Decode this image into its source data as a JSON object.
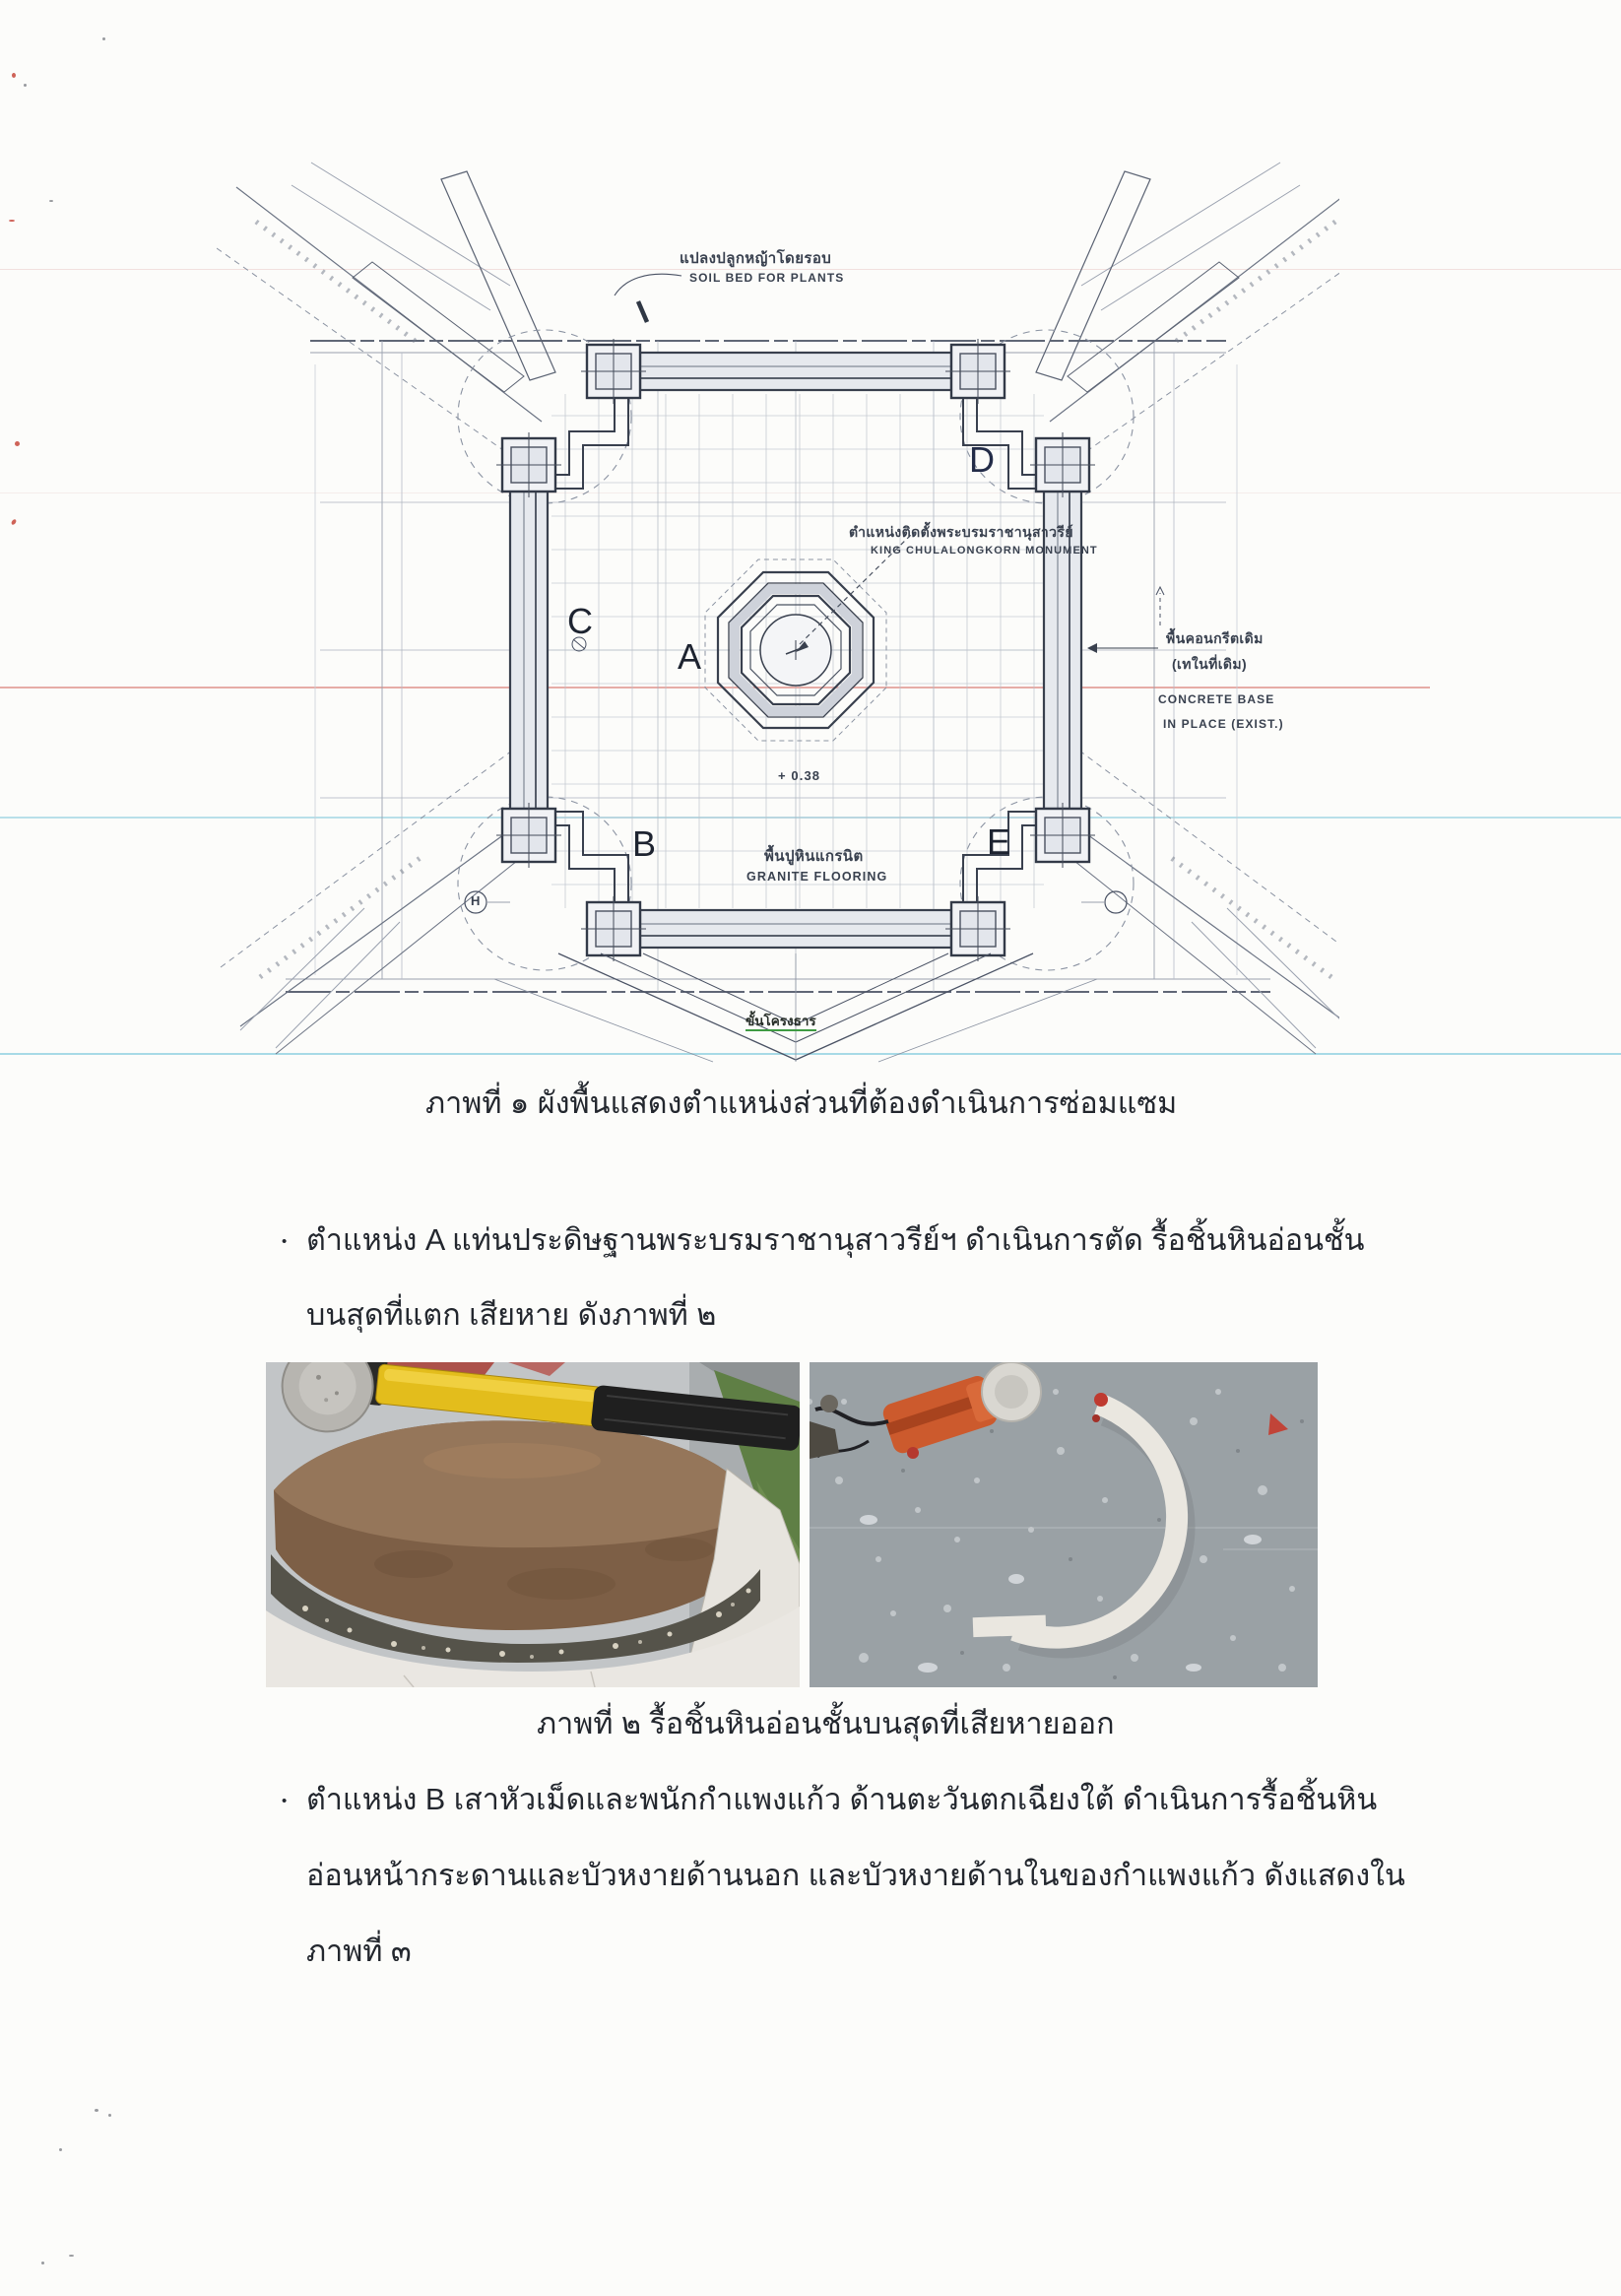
{
  "document": {
    "figure1_caption": "ภาพที่ ๑ ผังพื้นแสดงตำแหน่งส่วนที่ต้องดำเนินการซ่อมแซม",
    "figure2_caption": "ภาพที่ ๒ รื้อชิ้นหินอ่อนชั้นบนสุดที่เสียหายออก",
    "bullets": [
      {
        "marker": "•",
        "lines": [
          "ตำแหน่ง A แท่นประดิษฐานพระบรมราชานุสาวรีย์ฯ ดำเนินการตัด รื้อชิ้นหินอ่อนชั้น",
          "บนสุดที่แตก เสียหาย ดังภาพที่ ๒"
        ]
      },
      {
        "marker": "•",
        "lines": [
          "ตำแหน่ง B เสาหัวเม็ดและพนักกำแพงแก้ว ด้านตะวันตกเฉียงใต้ ดำเนินการรื้อชิ้นหิน",
          "อ่อนหน้ากระดานและบัวหงายด้านนอก และบัวหงายด้านในของกำแพงแก้ว ดังแสดงใน",
          "ภาพที่ ๓"
        ]
      }
    ]
  },
  "plan": {
    "position_labels": {
      "a": "A",
      "b": "B",
      "c": "C",
      "d": "D",
      "e": "E"
    },
    "grid_mark": "H",
    "annotations": {
      "soil_bed_th": "แปลงปลูกหญ้าโดยรอบ",
      "soil_bed_en": "SOIL BED FOR PLANTS",
      "monument_th": "ตำแหน่งติดตั้งพระบรมราชานุสาวรีย์",
      "monument_en": "KING CHULALONGKORN MONUMENT",
      "concrete_th_1": "พื้นคอนกรีตเดิม",
      "concrete_th_2": "(เทในที่เดิม)",
      "concrete_en_1": "CONCRETE BASE",
      "concrete_en_2": "IN PLACE (EXIST.)",
      "level_mark": "+ 0.38",
      "granite_th": "พื้นปูหินแกรนิต",
      "granite_en": "GRANITE FLOORING",
      "stair_label": "ขั้นโครงธาร"
    }
  },
  "colors": {
    "ink": "#39404e",
    "artifact_red": "#cc4c42",
    "artifact_cyan": "#76c4d8",
    "stair_green": "#3f9b43"
  }
}
